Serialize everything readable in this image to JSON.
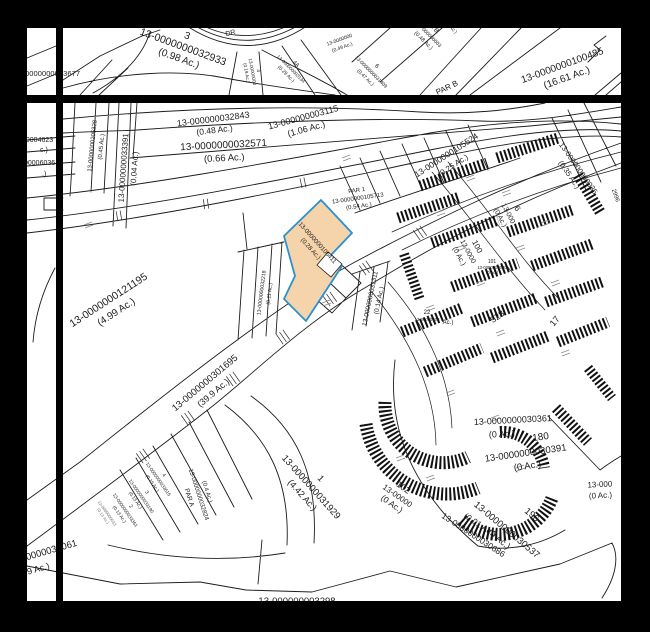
{
  "colors": {
    "highlight_fill": "#f6d4ab",
    "highlight_border": "#2a90d0",
    "line": "#1c1c1c",
    "frame": "#000000",
    "paper": "#ffffff"
  },
  "labels": {
    "lot3": {
      "lot": "3",
      "id": "13-0000000032933",
      "ac": "(0.98 Ac.)"
    },
    "street_dr": {
      "name": "DR"
    },
    "lot4": {
      "lot": "4",
      "id": "13-00000000",
      "ac": "(0.19 Ac.)"
    },
    "lot4a": {
      "lot": "4A",
      "id": "13-000000003134",
      "ac": "(0.29 Ac.)"
    },
    "p049": {
      "id": "13-0000000",
      "ac": "(0.49 Ac.)"
    },
    "lot6": {
      "lot": "6",
      "id": "13-0000000031409",
      "ac": "(0.47 Ac.)"
    },
    "lot7b": {
      "lot": "7B",
      "id": "13-000000003",
      "ac": "(0.48 Ac.)"
    },
    "lot8": {
      "lot": "8",
      "ac": "(0.45 Ac.)"
    },
    "par_b": {
      "name": "PAR B"
    },
    "p100485": {
      "id": "13-0000000100485",
      "ac": "(16.61 Ac.)"
    },
    "p32843": {
      "id": "13-000000032843",
      "ac": "(0.48 Ac.)"
    },
    "p32571": {
      "id": "13-0000000032571",
      "ac": "(0.66 Ac.)"
    },
    "p33391": {
      "id": "13-0000000033391",
      "ac": "(0.04 Ac.)"
    },
    "p205328": {
      "id": "13-0000000205328",
      "ac": "(0.45 Ac.)"
    },
    "frag_3677": {
      "id": "13-0000000033677"
    },
    "frag_4623": {
      "id": "00004623",
      "ac": "c.)"
    },
    "frag_6036": {
      "id": "00006036",
      "ac": ".)"
    },
    "p3115": {
      "id": "13-000000003115",
      "ac": "(1.06 Ac.)"
    },
    "p105524": {
      "id": "13-0000000105524",
      "ac": "(0.25 Ac.)"
    },
    "p30035": {
      "id": "13-000000030035",
      "ac": "(0.35 Ac.)"
    },
    "frag_2996": {
      "id": "2996"
    },
    "par1": {
      "lot": "PAR 1",
      "id": "13-0000000105713",
      "ac": "(0.54 Ac.)"
    },
    "highlight": {
      "id": "13-0000000105411",
      "ac": "(0.28 Ac.)"
    },
    "p32218": {
      "id": "13-0000000032218",
      "ac": "(0.11 Ac.)"
    },
    "p31311": {
      "id": "13-0000000031311",
      "ac": "(0.14 Ac.)"
    },
    "lot22": {
      "lot": "22",
      "id": "13-00000000",
      "ac": "Ac.)"
    },
    "lot100": {
      "lot": "100",
      "id": "13-0000",
      "ac": "(0 Ac.)"
    },
    "lot101": {
      "lot": "101",
      "id": "13-0000000030",
      "ac": "(0 Ac.)"
    },
    "lot6b": {
      "lot": "6",
      "id": "13-000",
      "ac": "(0 Ac.)"
    },
    "lot528": {
      "lot": "528"
    },
    "lot17": {
      "lot": "17"
    },
    "p30361": {
      "id": "13-0000000030361",
      "ac": "(0 Ac.)"
    },
    "lot180": {
      "lot": "180"
    },
    "p30391": {
      "id": "13-0000000030391",
      "ac": "(0 Ac.)"
    },
    "lot102": {
      "lot": "102",
      "id": "13-00000",
      "ac": "(0 Ac.)"
    },
    "p30686": {
      "id": "13-0000000030686",
      "ac": "(0.01 Ac.)"
    },
    "lot196": {
      "lot": "196"
    },
    "p30537": {
      "id": "13-0000000030537",
      "ac": "(0 Ac.)"
    },
    "frag_right": {
      "id": "13-000",
      "ac": "(0 Ac.)"
    },
    "p121195": {
      "id": "13-0000000121195",
      "ac": "(4.99 Ac.)"
    },
    "p301695": {
      "id": "13-0000000301695",
      "ac": "(39.9 Ac.)"
    },
    "p31929": {
      "lot": "1",
      "id": "13-0000000031929",
      "ac": "(4.42 Ac.)"
    },
    "fan4": {
      "lot": "4",
      "id": "13-0000000033616",
      "ac": "(0.15 Ac.)"
    },
    "fan3": {
      "lot": "3",
      "id": "13-0000000033190",
      "ac": "(0.13 Ac.)"
    },
    "fan2": {
      "lot": "2",
      "id": "13-0000000033361",
      "ac": "(0.13 Ac.)"
    },
    "fan_tiny": {
      "id": "13-0000000033",
      "ac": "(0.13 Ac.)"
    },
    "par_a": {
      "lot": "PAR A",
      "id": "13-0000000032824",
      "ac": "(0.4 Ac.)"
    },
    "p34061": {
      "id": "13-0000000034061",
      "ac": "(1.9 Ac.)"
    },
    "bottom_cut": {
      "id": "13-000000003298"
    }
  }
}
